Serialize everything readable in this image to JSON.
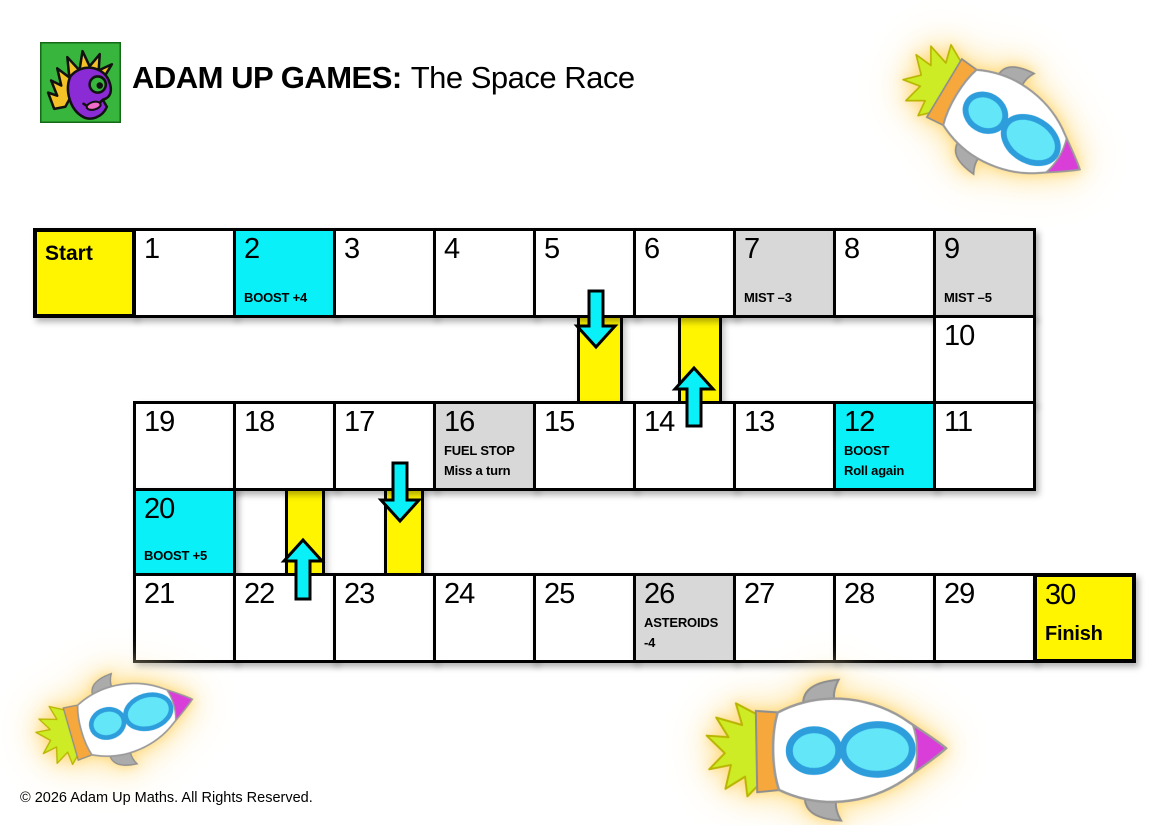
{
  "header": {
    "brand_bold": "ADAM UP GAMES:",
    "title_regular": "The Space Race",
    "logo": "adam-up-games-monster-logo"
  },
  "footer": {
    "copyright": "© 2026 Adam Up Maths. All Rights Reserved."
  },
  "palette": {
    "yellow": "#fff500",
    "cyan": "#0af0f8",
    "gray": "#d8d8d8",
    "white": "#ffffff",
    "border": "#000000",
    "arrow": "#0af0f8"
  },
  "board": {
    "columns_x_origin": 33,
    "cell_width": 100,
    "rows_y": [
      228,
      315,
      401,
      488,
      573
    ],
    "rows_h": [
      87,
      86,
      87,
      85,
      87
    ],
    "cells": [
      {
        "label": "Start",
        "fill": "yellow",
        "row": 0,
        "col": 0,
        "thick": true,
        "label_bold": true
      },
      {
        "label": "1",
        "fill": "white",
        "row": 0,
        "col": 1
      },
      {
        "label": "2",
        "note": "BOOST +4",
        "fill": "cyan",
        "row": 0,
        "col": 2
      },
      {
        "label": "3",
        "fill": "white",
        "row": 0,
        "col": 3
      },
      {
        "label": "4",
        "fill": "white",
        "row": 0,
        "col": 4
      },
      {
        "label": "5",
        "fill": "white",
        "row": 0,
        "col": 5
      },
      {
        "label": "6",
        "fill": "white",
        "row": 0,
        "col": 6
      },
      {
        "label": "7",
        "note": "MIST –3",
        "fill": "gray",
        "row": 0,
        "col": 7
      },
      {
        "label": "8",
        "fill": "white",
        "row": 0,
        "col": 8
      },
      {
        "label": "9",
        "note": "MIST –5",
        "fill": "gray",
        "row": 0,
        "col": 9
      },
      {
        "label": "10",
        "fill": "white",
        "row": 1,
        "col": 9
      },
      {
        "label": "19",
        "fill": "white",
        "row": 2,
        "col": 1
      },
      {
        "label": "18",
        "fill": "white",
        "row": 2,
        "col": 2
      },
      {
        "label": "17",
        "fill": "white",
        "row": 2,
        "col": 3
      },
      {
        "label": "16",
        "note": "FUEL STOP\nMiss a turn",
        "fill": "gray",
        "row": 2,
        "col": 4
      },
      {
        "label": "15",
        "fill": "white",
        "row": 2,
        "col": 5
      },
      {
        "label": "14",
        "fill": "white",
        "row": 2,
        "col": 6
      },
      {
        "label": "13",
        "fill": "white",
        "row": 2,
        "col": 7
      },
      {
        "label": "12",
        "note": "BOOST\nRoll again",
        "fill": "cyan",
        "row": 2,
        "col": 8
      },
      {
        "label": "11",
        "fill": "white",
        "row": 2,
        "col": 9
      },
      {
        "label": "20",
        "note": "BOOST +5",
        "fill": "cyan",
        "row": 3,
        "col": 1
      },
      {
        "label": "21",
        "fill": "white",
        "row": 4,
        "col": 1
      },
      {
        "label": "22",
        "fill": "white",
        "row": 4,
        "col": 2
      },
      {
        "label": "23",
        "fill": "white",
        "row": 4,
        "col": 3
      },
      {
        "label": "24",
        "fill": "white",
        "row": 4,
        "col": 4
      },
      {
        "label": "25",
        "fill": "white",
        "row": 4,
        "col": 5
      },
      {
        "label": "26",
        "note": "ASTEROIDS\n-4",
        "fill": "gray",
        "row": 4,
        "col": 6
      },
      {
        "label": "27",
        "fill": "white",
        "row": 4,
        "col": 7
      },
      {
        "label": "28",
        "fill": "white",
        "row": 4,
        "col": 8
      },
      {
        "label": "29",
        "fill": "white",
        "row": 4,
        "col": 9
      },
      {
        "label": "30",
        "note": "Finish",
        "fill": "yellow",
        "row": 4,
        "col": 10,
        "thick": true,
        "note_large": true
      }
    ],
    "chutes": [
      {
        "name": "chute-5-to-15",
        "x": 577,
        "w": 46,
        "row": 1
      },
      {
        "name": "chute-14-to-6",
        "x": 678,
        "w": 44,
        "row": 1
      },
      {
        "name": "chute-22-to-18",
        "x": 285,
        "w": 40,
        "row": 3
      },
      {
        "name": "chute-17-to-23",
        "x": 384,
        "w": 40,
        "row": 3
      }
    ],
    "arrows": [
      {
        "name": "arrow-down-5-to-15",
        "dir": "down",
        "cx": 596,
        "y0": 291,
        "y1": 347
      },
      {
        "name": "arrow-up-14-to-6",
        "dir": "up",
        "cx": 694,
        "y0": 368,
        "y1": 426
      },
      {
        "name": "arrow-down-17-to-23",
        "dir": "down",
        "cx": 400,
        "y0": 463,
        "y1": 521
      },
      {
        "name": "arrow-up-22-to-18",
        "dir": "up",
        "cx": 303,
        "y0": 540,
        "y1": 599
      }
    ]
  },
  "decorations": {
    "rockets": [
      "rocket-top-right",
      "rocket-bottom-left",
      "rocket-bottom-center"
    ]
  }
}
